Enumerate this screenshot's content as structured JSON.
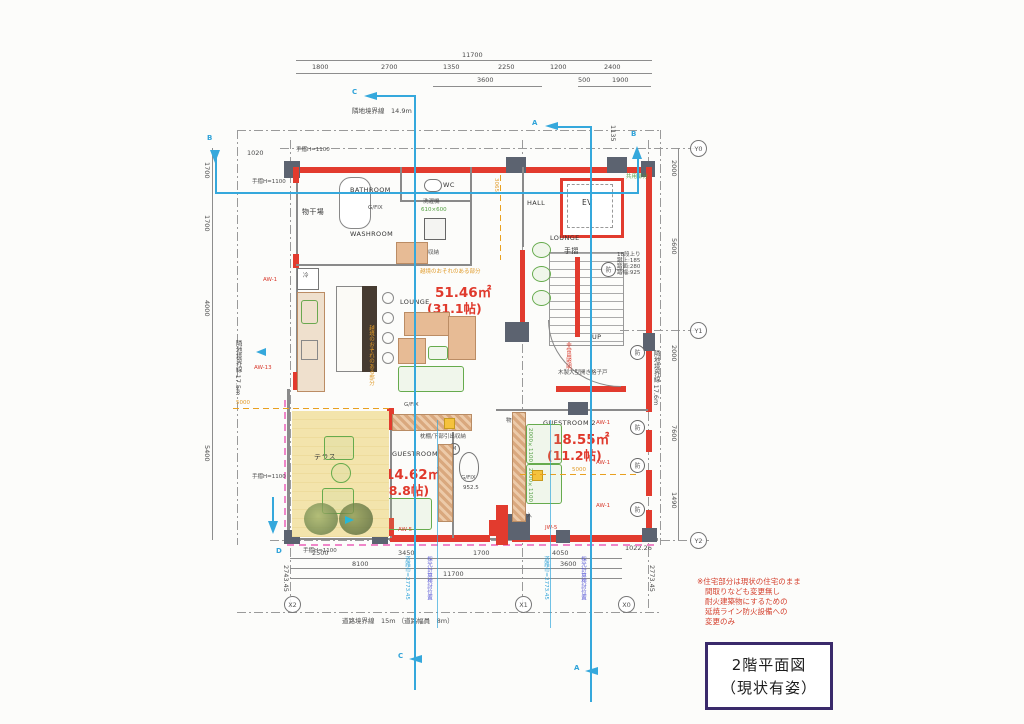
{
  "title": {
    "l1": "2階平面図",
    "l2": "（現状有姿）"
  },
  "note": {
    "l1": "※住宅部分は現状の住宅のまま",
    "l2": "間取りなども変更無し",
    "l3": "耐火建築物にするための",
    "l4": "延焼ライン防火設備への",
    "l5": "変更のみ"
  },
  "boundary": {
    "top": "隣地境界線　14.9m",
    "left": "隣地境界線 17.5m",
    "right": "隣地境界線 17.6m",
    "bottom": "道路境界線　15m （道路幅員　8m）"
  },
  "room": {
    "bathroom": "BATHROOM",
    "washroom": "WASHROOM",
    "wc": "WC",
    "hall": "HALL",
    "ev": "EV",
    "lounge": "LOUNGE",
    "guest1": "GUESTROOM 1",
    "guest2": "GUESTROOM 2",
    "terrace": "テラス",
    "monohoshi": "物干場",
    "shunou": "収納",
    "monoire": "物入",
    "rei": "冷",
    "tesuri": "手摺",
    "up": "UP",
    "gfix": "G/FIX",
    "washer": "洗濯機",
    "washer_size": "610×600",
    "makuradana": "枕棚/下部引出収納",
    "m": "M"
  },
  "area": {
    "lounge_m2": "51.46㎡",
    "lounge_j": "(31.1帖)",
    "g1_m2": "14.62㎡",
    "g1_j": "(8.8帖)",
    "g2_m2": "18.55㎡",
    "g2_j": "(11.2帖)"
  },
  "win": {
    "aw1": "AW-1",
    "aw13": "AW-13",
    "aw5": "AW-5",
    "jw5": "JW-5"
  },
  "note2": {
    "bou": "防",
    "stair1": "18段上り",
    "stair2": "蹴上:185",
    "stair3": "踏面:280",
    "stair4": "踏幅:925",
    "emergency": "非常用照明",
    "wooddoor": "木製大型開き格子戸",
    "common": "共用部分",
    "ekkyo": "越境のおそれのある部分",
    "tesuri_h": "手摺H=1100"
  },
  "dim": {
    "t_total": "11700",
    "t1": "1800",
    "t2": "2700",
    "t3": "1350",
    "t4": "2250",
    "t5": "1200",
    "t6": "2400",
    "t_sub": "3600",
    "t_sub2": "500",
    "t_sub3": "1900",
    "l1": "1700",
    "l2": "1700",
    "l3": "4000",
    "l4": "5400",
    "l_small": "1020",
    "r1": "2000",
    "r2": "5600",
    "r3": "2000",
    "r4": "7600",
    "r5": "1490",
    "r_small": "1135",
    "b1": "2500",
    "b2": "3450",
    "b3": "1700",
    "b4": "4050",
    "b5": "8100",
    "b6": "3600",
    "b_total": "11700",
    "b_lv": "2743.45",
    "b_rv": "2773.45",
    "corner": "1022.26",
    "d850": "850",
    "d952": "952.5",
    "d5000": "5000",
    "d3065": "3065",
    "bed": "2000×1100"
  },
  "grid": {
    "x2": "X2",
    "x1": "X1",
    "x0": "X0",
    "y0": "Y0",
    "y1": "Y1",
    "y2": "Y2"
  },
  "sec": {
    "a": "A",
    "b": "B",
    "c": "C",
    "d": "D"
  },
  "bluetext": {
    "road": "道路巾=2773.45",
    "light": "採光計算検討位置"
  },
  "colors": {
    "wall_red": "#e23b2e",
    "section_blue": "#35a8dc",
    "note_red": "#d5412e",
    "common_green": "#4f9e3e",
    "encroach_orange": "#e09a28",
    "title_border": "#3a2a6b"
  }
}
